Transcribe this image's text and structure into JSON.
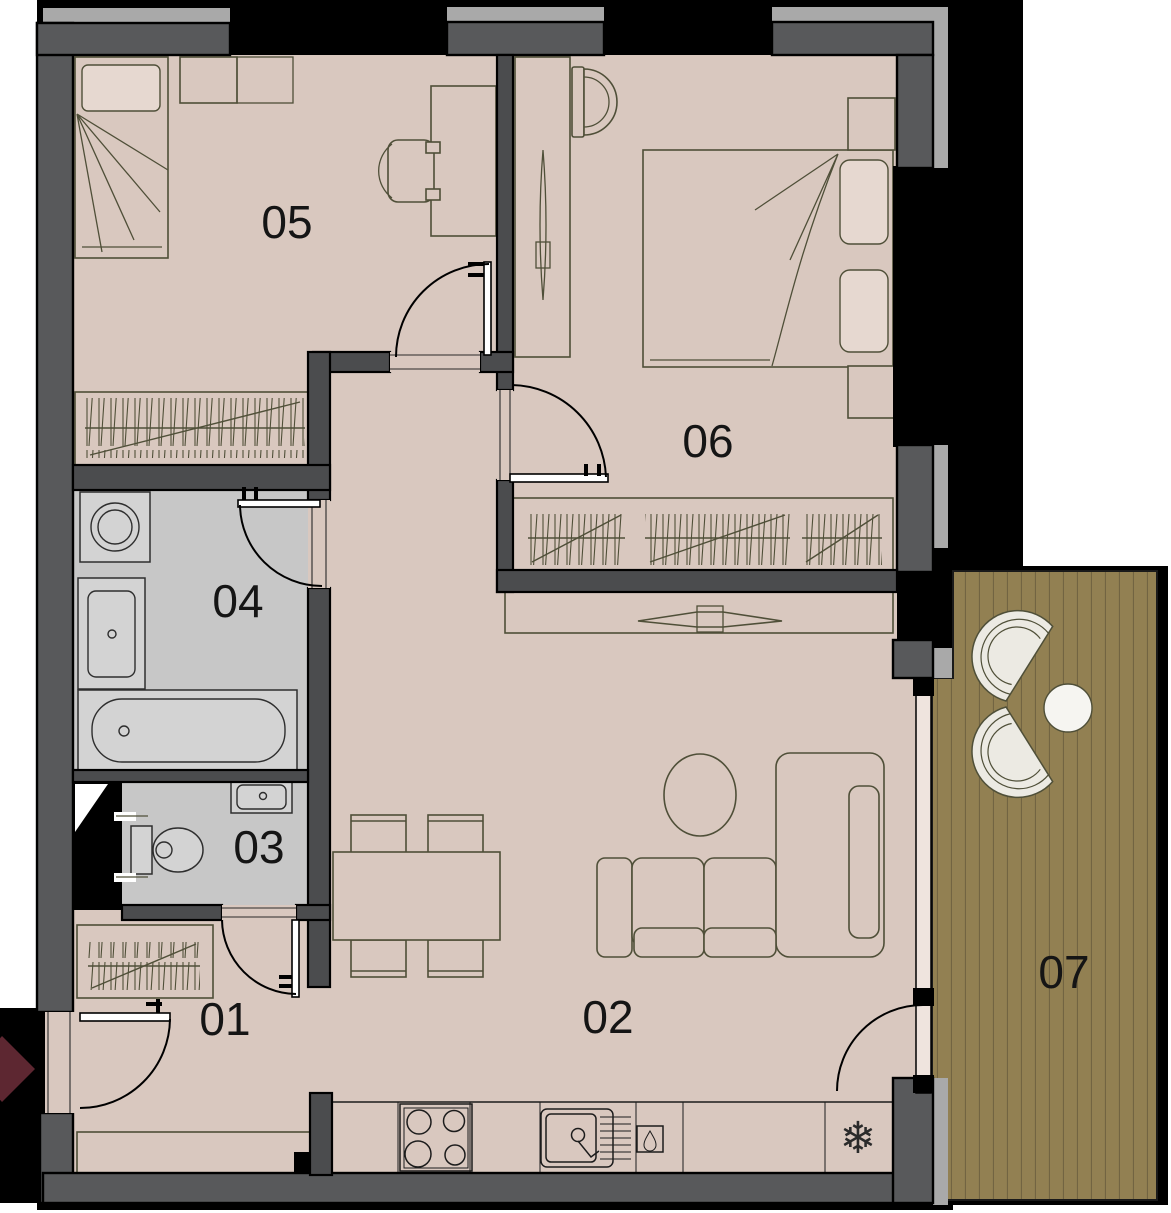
{
  "plan": {
    "rooms": [
      {
        "label": "01"
      },
      {
        "label": "02"
      },
      {
        "label": "03"
      },
      {
        "label": "04"
      },
      {
        "label": "05"
      },
      {
        "label": "06"
      },
      {
        "label": "07"
      }
    ],
    "icons": {
      "fridge_snowflake": "❄"
    },
    "colors": {
      "wall": "#58595b",
      "cap": "#a9a9a9",
      "floor": "#d9c8bf",
      "wet": "#c7c7c7",
      "deck": "#928052",
      "deckline": "#6e6040",
      "olive": "#4f4f38",
      "arrow": "#5d2731"
    }
  }
}
